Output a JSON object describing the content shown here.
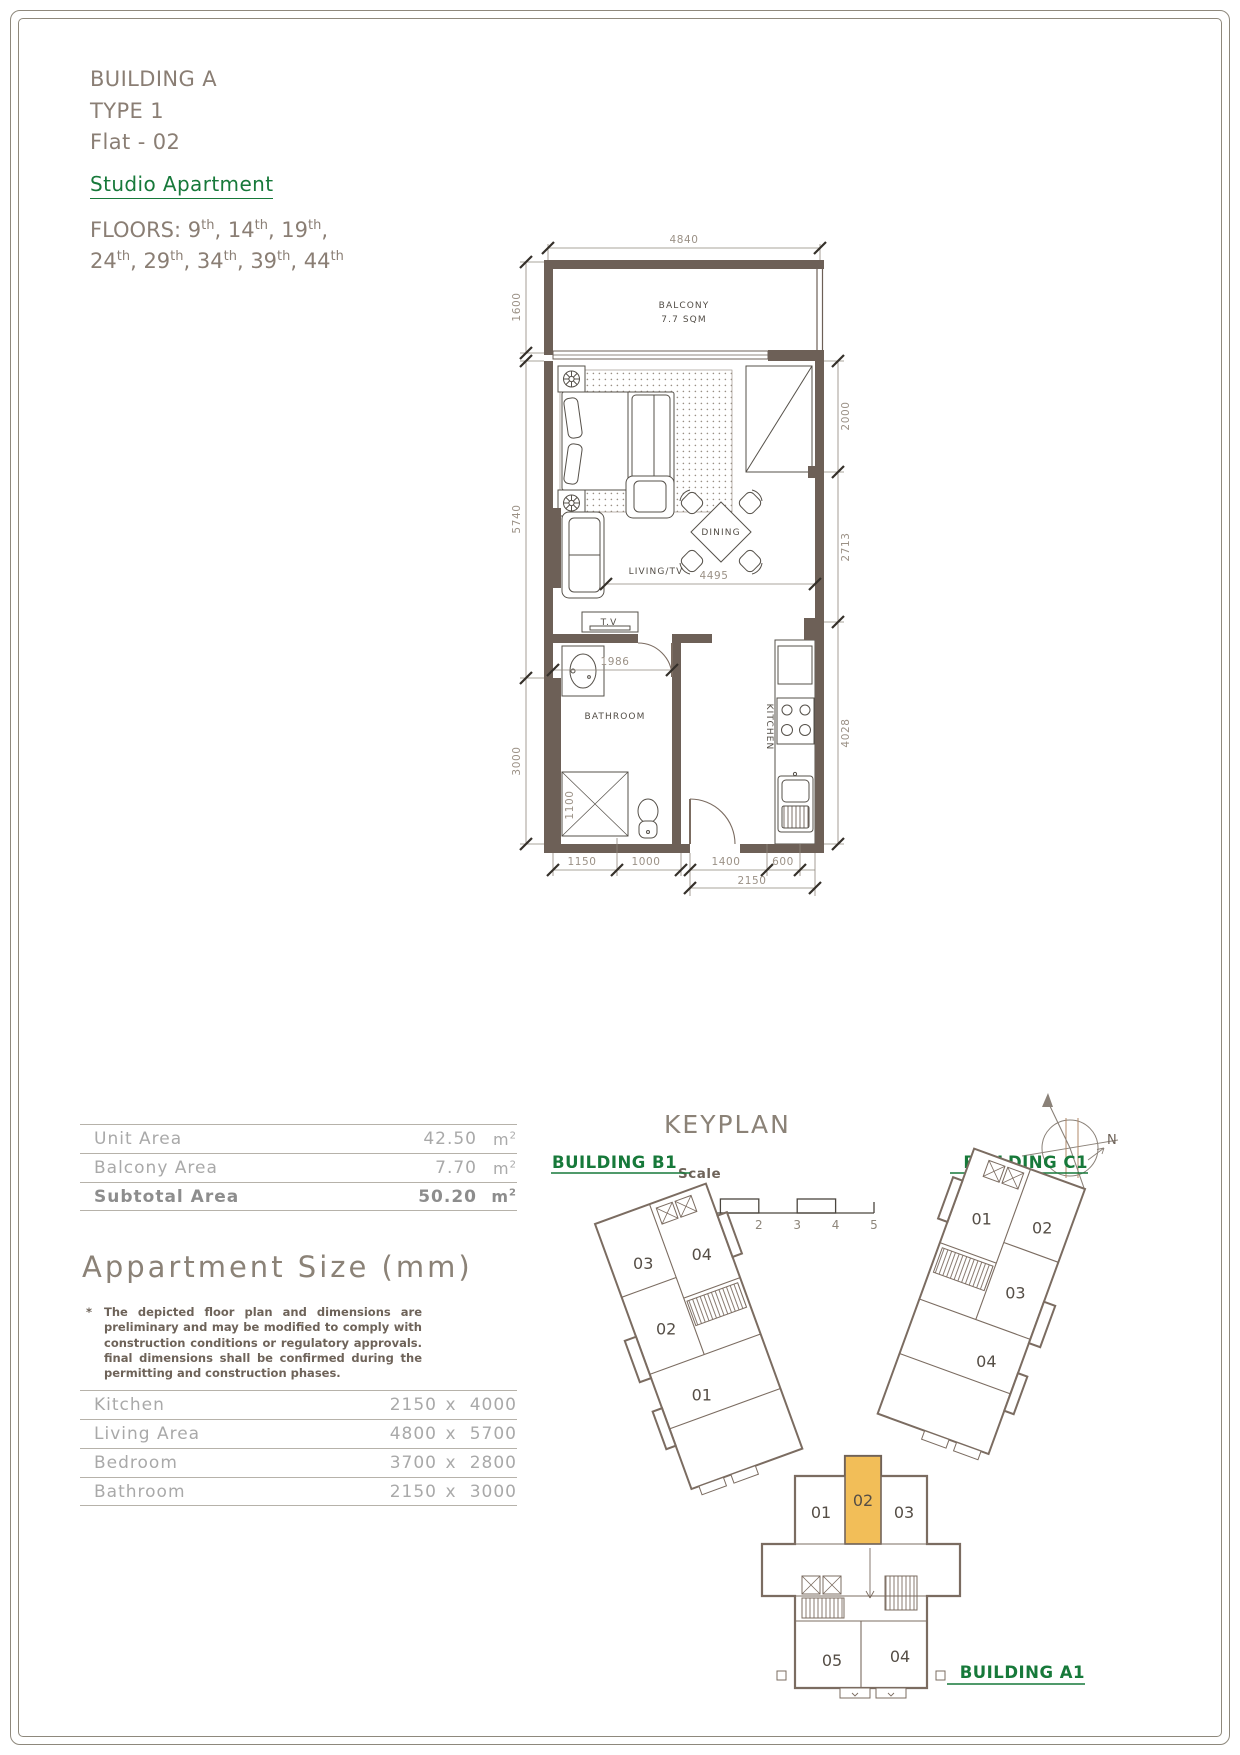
{
  "header": {
    "building": "BUILDING A",
    "type_line": "TYPE 1",
    "flat": "Flat - 02",
    "category": "Studio Apartment",
    "floors_label": "FLOORS:",
    "floors": [
      {
        "n": "9",
        "s": "th",
        "sep": ", "
      },
      {
        "n": "14",
        "s": "th",
        "sep": ", "
      },
      {
        "n": "19",
        "s": "th",
        "sep": ","
      },
      {
        "n": "24",
        "s": "th",
        "sep": ", "
      },
      {
        "n": "29",
        "s": "th",
        "sep": ", "
      },
      {
        "n": "34",
        "s": "th",
        "sep": ", "
      },
      {
        "n": "39",
        "s": "th",
        "sep": ", "
      },
      {
        "n": "44",
        "s": "th",
        "sep": ""
      }
    ]
  },
  "plan": {
    "labels": {
      "balcony": "BALCONY",
      "balcony_area": "7.7 SQM",
      "dining": "DINING",
      "living": "LIVING/TV",
      "tv": "T.V",
      "bathroom": "BATHROOM",
      "kitchen": "KITCHEN"
    },
    "dims": {
      "top": "4840",
      "balcony_h": "1600",
      "left_main": "5740",
      "left_bath": "3000",
      "right_top": "2000",
      "right_mid": "2713",
      "right_bot": "4028",
      "living_w": "4495",
      "bath_w": "1986",
      "shower_h": "1100",
      "b1": "1150",
      "b2": "1000",
      "b3": "1400",
      "b4": "600",
      "b5": "2150"
    }
  },
  "area_table": {
    "rows": [
      {
        "label": "Unit Area",
        "value": "42.50",
        "unit": "m",
        "sup": "2"
      },
      {
        "label": "Balcony Area",
        "value": "7.70",
        "unit": "m",
        "sup": "2"
      },
      {
        "label": "Subtotal Area",
        "value": "50.20",
        "unit": "m",
        "sup": "2"
      }
    ]
  },
  "size_section": {
    "title": "Appartment Size (mm)",
    "star": "*",
    "note": "The depicted floor plan and dimensions are preliminary and may be modified to comply with construction conditions or regulatory approvals. final dimensions shall be confirmed during the permitting and construction phases.",
    "rows": [
      {
        "label": "Kitchen",
        "w": "2150",
        "x": "x",
        "h": "4000"
      },
      {
        "label": "Living Area",
        "w": "4800",
        "x": "x",
        "h": "5700"
      },
      {
        "label": "Bedroom",
        "w": "3700",
        "x": "x",
        "h": "2800"
      },
      {
        "label": "Bathroom",
        "w": "2150",
        "x": "x",
        "h": "3000"
      }
    ]
  },
  "keyplan": {
    "title": "KEYPLAN",
    "scale_label": "Scale",
    "ticks": [
      "0",
      "1",
      "2",
      "3",
      "4",
      "5"
    ],
    "north": "N",
    "highlight_unit": "02",
    "b1": {
      "name": "BUILDING B1",
      "u01": "01",
      "u02": "02",
      "u03": "03",
      "u04": "04"
    },
    "c1": {
      "name": "BUILDING C1",
      "u01": "01",
      "u02": "02",
      "u03": "03",
      "u04": "04"
    },
    "a1": {
      "name": "BUILDING A1",
      "u01": "01",
      "u02": "02",
      "u03": "03",
      "u04": "04",
      "u05": "05"
    }
  },
  "colors": {
    "wall": "#6d6057",
    "accent_green": "#17793a",
    "highlight_orange": "#f2be58",
    "dim_text": "#9b9186",
    "keyplan_stroke": "#7b6c61"
  }
}
